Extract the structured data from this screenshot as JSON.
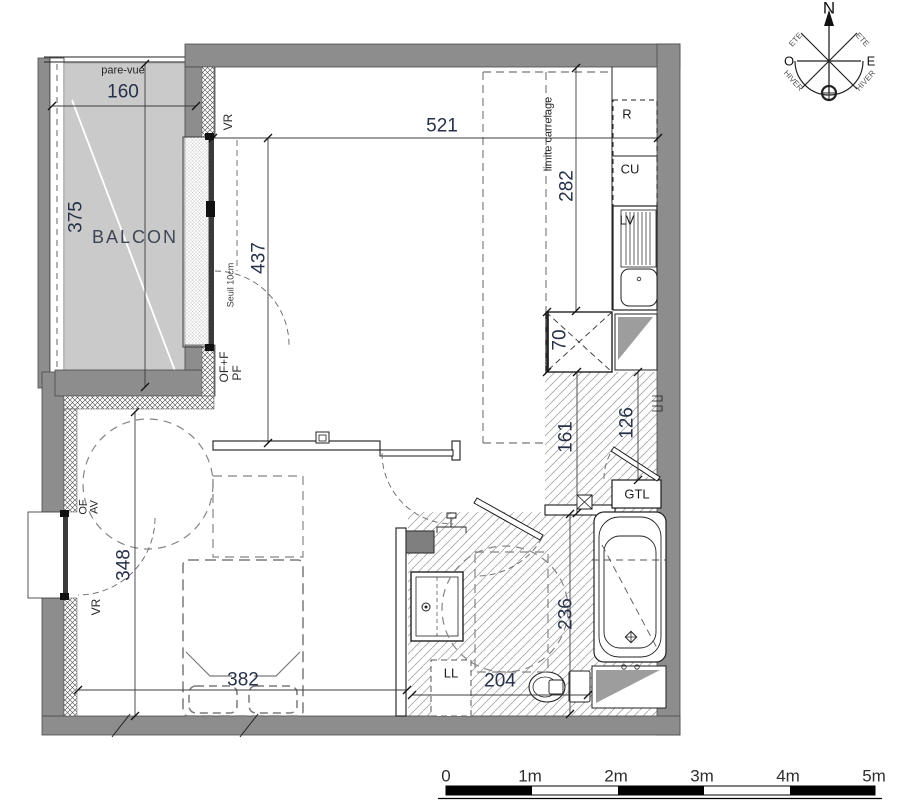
{
  "plan": {
    "balcony": {
      "name": "BALCON",
      "pare_vue": "pare-vue",
      "dim_width": "160",
      "dim_depth": "375"
    },
    "living": {
      "dim_width": "521",
      "dim_depth": "437",
      "vr": "VR",
      "seuil": "Seuil 10cm",
      "of_f": "OF+F",
      "pf": "PF"
    },
    "kitchen": {
      "limite": "limite carrelage",
      "dim_depth": "282",
      "r": "R",
      "cu": "CU",
      "lv": "LV",
      "dim_col": "70"
    },
    "hall": {
      "dim_a": "161",
      "dim_b": "126",
      "gtl": "GTL"
    },
    "bath": {
      "dim_width": "204",
      "dim_depth": "236",
      "ll": "LL"
    },
    "bedroom": {
      "dim_width": "382",
      "dim_depth": "348",
      "of": "OF",
      "av": "AV",
      "vr": "VR"
    }
  },
  "compass": {
    "n": "N",
    "o": "O",
    "e": "E",
    "ete": "ETE",
    "hiver": "HIVER"
  },
  "scalebar": {
    "labels": [
      "0",
      "1m",
      "2m",
      "3m",
      "4m",
      "5m"
    ]
  },
  "colors": {
    "wall": "#8d8d8d",
    "balcony_floor": "#cacaca",
    "counter_gray": "#9d9d9d",
    "dim_text": "#263149"
  }
}
